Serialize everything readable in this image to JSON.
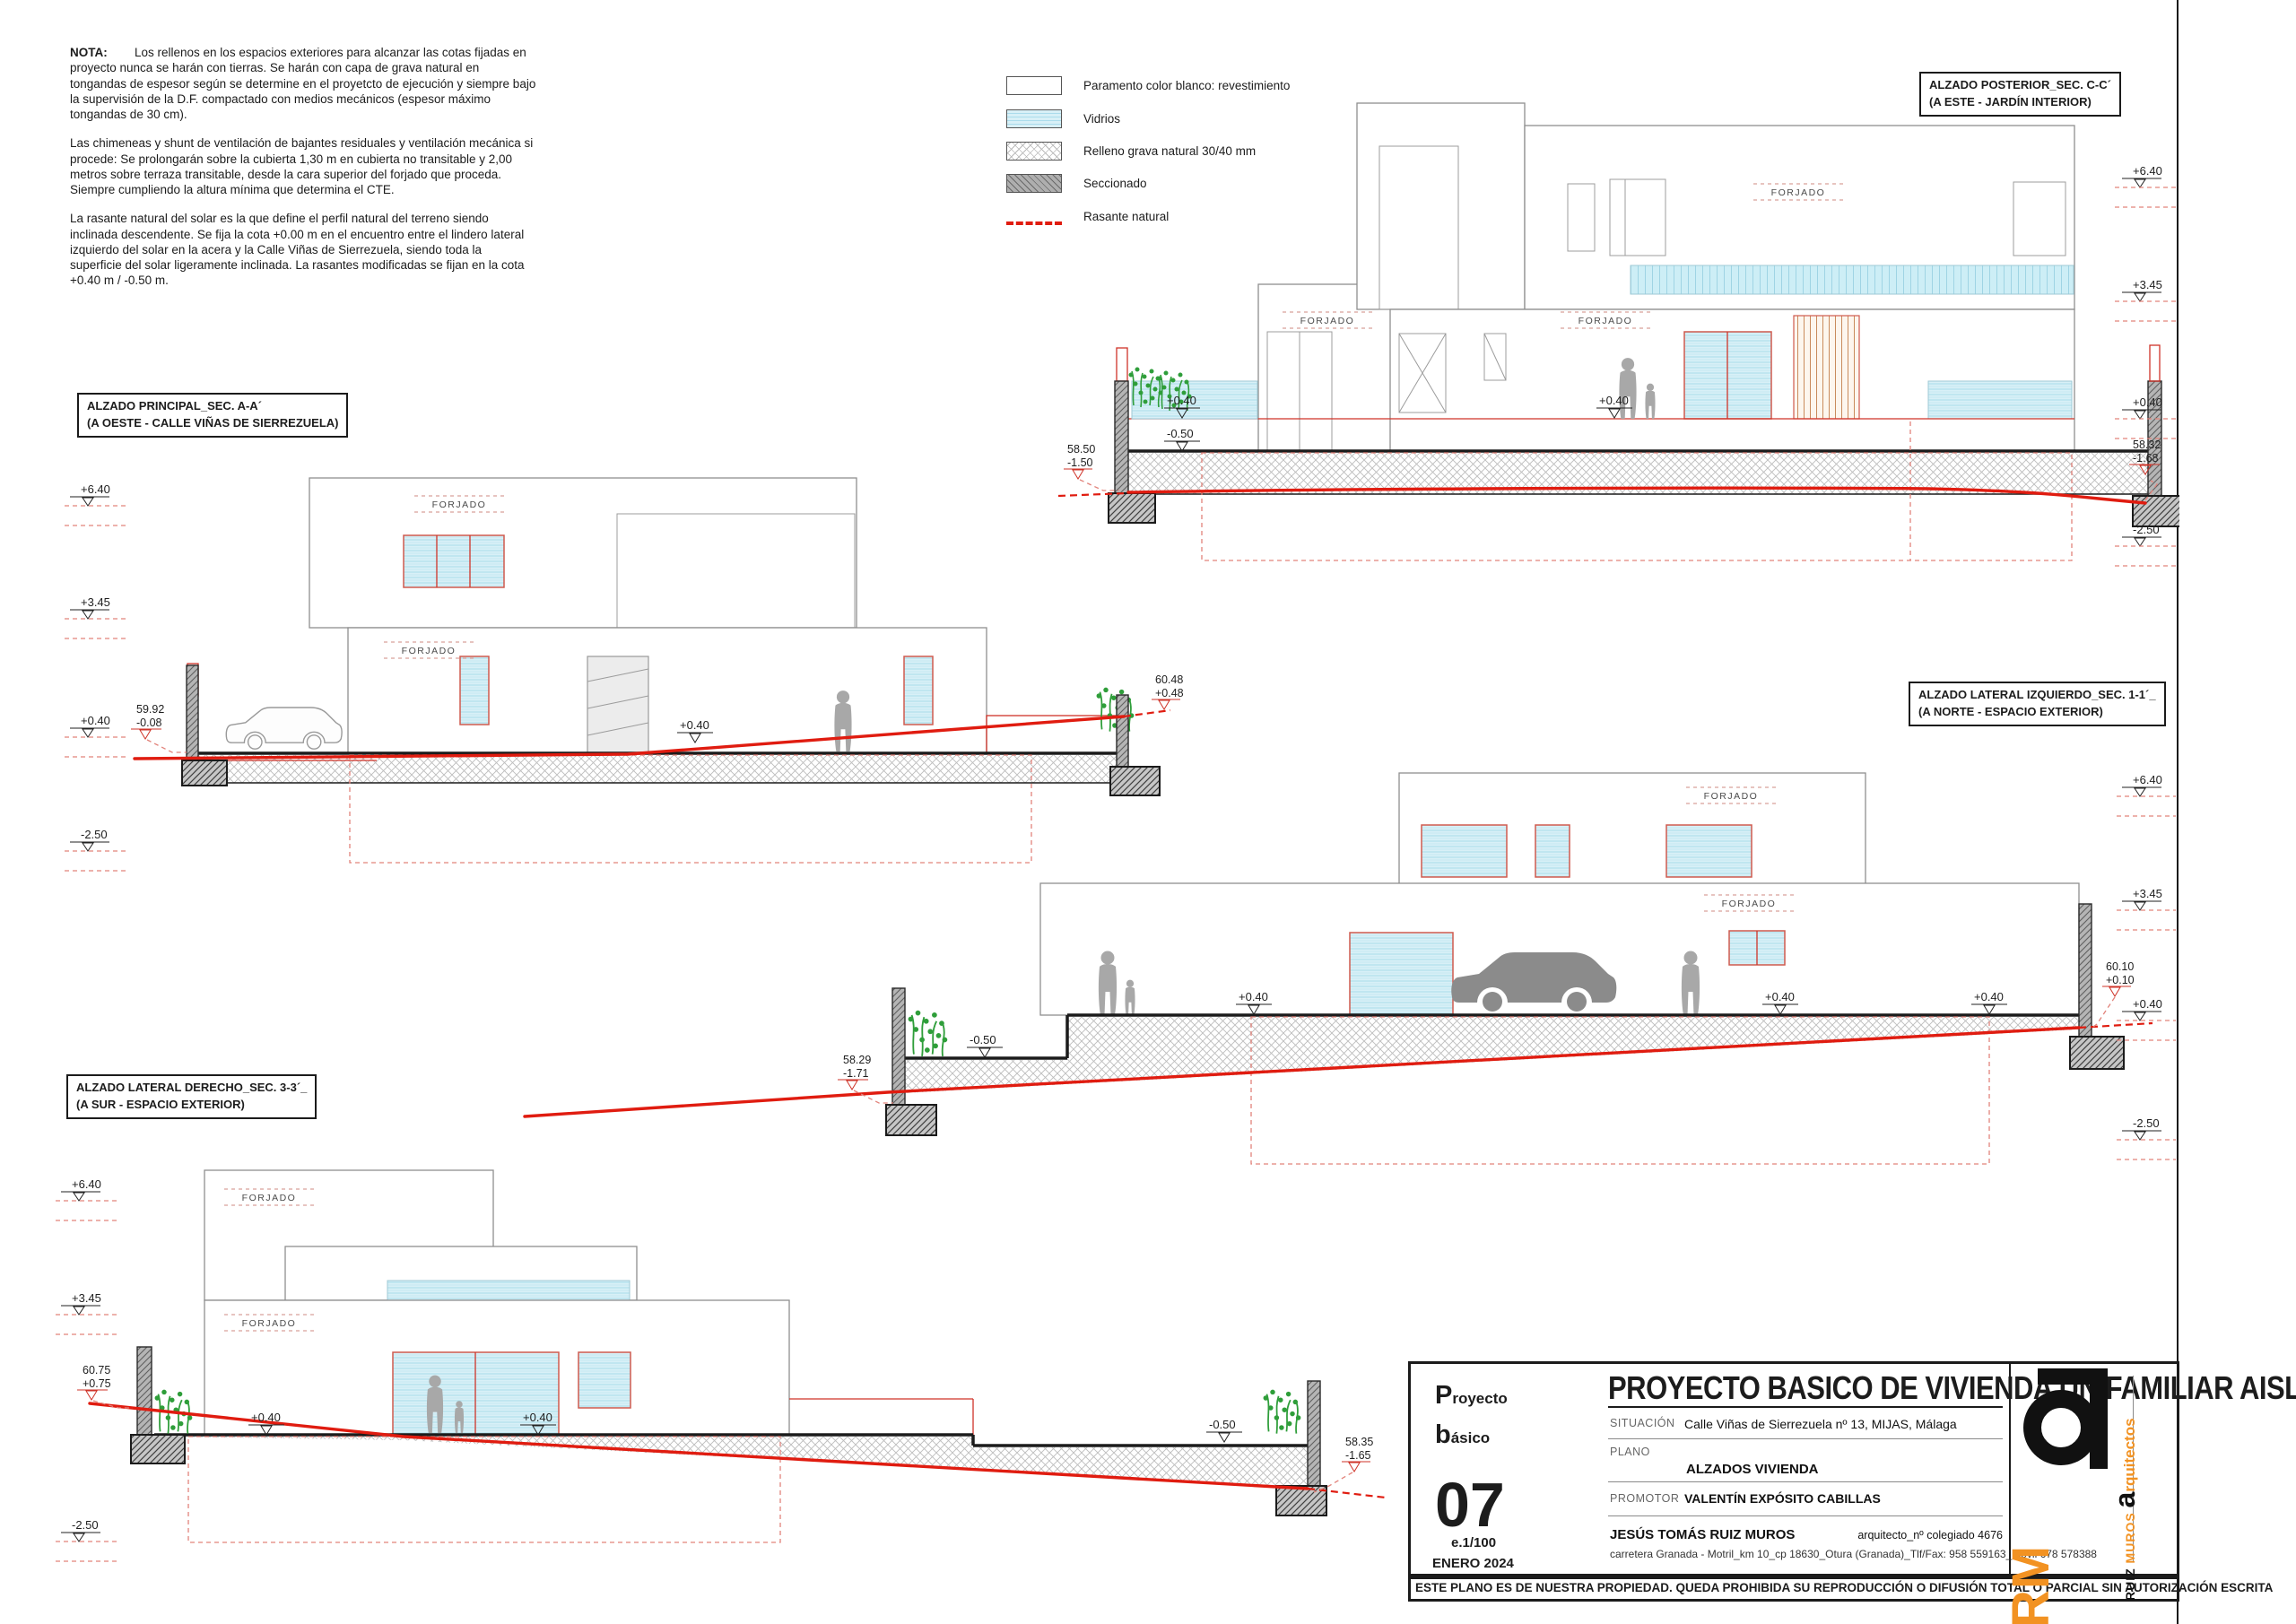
{
  "nota": {
    "label": "NOTA:",
    "p1": "Los rellenos en los espacios exteriores para alcanzar las cotas fijadas en proyecto nunca se harán con tierras. Se harán con capa de grava natural en tongandas de espesor según se determine en el proyetcto de ejecución y siempre bajo la supervisión de la D.F. compactado con medios mecánicos (espesor máximo tongandas de 30 cm).",
    "p2": "Las chimeneas y shunt de ventilación de bajantes residuales y ventilación mecánica si procede: Se prolongarán sobre la cubierta 1,30 m en cubierta no transitable y 2,00 metros sobre terraza transitable, desde la cara superior del forjado que proceda. Siempre cumpliendo la altura mínima que determina el CTE.",
    "p3": "La rasante natural del solar es la que define el perfil natural del terreno siendo inclinada descendente. Se fija la cota +0.00 m en el encuentro entre el lindero lateral izquierdo del solar en la acera y la Calle Viñas de Sierrezuela, siendo toda la superficie del solar ligeramente inclinada. La rasantes modificadas se fijan en la cota +0.40 m / -0.50 m."
  },
  "legend": {
    "paramento": "Paramento color blanco: revestimiento",
    "vidrios": "Vidrios",
    "grava": "Relleno grava natural 30/40 mm",
    "seccionado": "Seccionado",
    "rasante": "Rasante natural"
  },
  "sections": {
    "posterior": {
      "title": "ALZADO POSTERIOR_SEC. C-C´",
      "subtitle": "(A ESTE - JARDÍN INTERIOR)"
    },
    "principal": {
      "title": "ALZADO PRINCIPAL_SEC. A-A´",
      "subtitle": "(A OESTE - CALLE VIÑAS DE SIERREZUELA)"
    },
    "izquierdo": {
      "title": "ALZADO LATERAL IZQUIERDO_SEC. 1-1´_",
      "subtitle": "(A NORTE - ESPACIO EXTERIOR)"
    },
    "derecho": {
      "title": "ALZADO LATERAL DERECHO_SEC. 3-3´_",
      "subtitle": "(A SUR - ESPACIO EXTERIOR)"
    }
  },
  "drawings": {
    "forjado": "FORJADO",
    "posterior": {
      "marks": [
        "+6.40",
        "+3.45",
        "+0.40",
        "-2.50"
      ],
      "left_abs": "58.50",
      "left_rel": "-1.50",
      "right_abs": "58.32",
      "right_rel": "-1.68",
      "c1": "+0.40",
      "c2": "-0.50",
      "c3": "+0.40"
    },
    "principal": {
      "marks": [
        "+6.40",
        "+3.45",
        "+0.40",
        "-2.50"
      ],
      "left_abs": "59.92",
      "left_rel": "-0.08",
      "right_abs": "60.48",
      "right_rel": "+0.48",
      "c1": "+0.40"
    },
    "izquierdo": {
      "marks": [
        "+6.40",
        "+3.45",
        "+0.40",
        "-2.50"
      ],
      "left_abs": "58.29",
      "left_rel": "-1.71",
      "right_abs": "60.10",
      "right_rel": "+0.10",
      "c1": "+0.40",
      "c2": "+0.40",
      "c3": "+0.40",
      "c4": "-0.50"
    },
    "derecho": {
      "marks": [
        "+6.40",
        "+3.45",
        "-2.50"
      ],
      "left_abs": "60.75",
      "left_rel": "+0.75",
      "right_abs": "58.35",
      "right_rel": "-1.65",
      "c1": "+0.40",
      "c2": "+0.40",
      "c3": "-0.50"
    }
  },
  "titleblock": {
    "kicker_big1": "P",
    "kicker_rest1": "royecto",
    "kicker_big2": "b",
    "kicker_rest2": "ásico",
    "title": "PROYECTO BASICO DE VIVIENDA UNIFAMILIAR AISLADA",
    "situacion_label": "SITUACIÓN",
    "situacion": "Calle Viñas de Sierrezuela nº 13, MIJAS, Málaga",
    "plano_label": "PLANO",
    "plano": "ALZADOS VIVIENDA",
    "promotor_label": "PROMOTOR",
    "promotor": "VALENTÍN EXPÓSITO CABILLAS",
    "sheet_number": "07",
    "scale": "e.1/100",
    "date": "ENERO 2024",
    "architect": "JESÚS TOMÁS RUIZ MUROS",
    "architect_info": "arquitecto_nº colegiado 4676",
    "architect_address": "carretera Granada - Motril_km 10_cp 18630_Otura (Granada)_Tlf/Fax: 958 559163_móvil 678 578388",
    "copyright": "ESTE PLANO ES DE NUESTRA PROPIEDAD. QUEDA PROHIBIDA SU REPRODUCCIÓN O DIFUSIÓN TOTAL O PARCIAL  SIN AUTORIZACIÓN ESCRITA",
    "logo_rm": "RM",
    "logo_a": "a",
    "firm_ruiz": "RUIZ ",
    "firm_muros": "MUROS ",
    "firm_a": "a",
    "firm_rest": "rquitectos"
  }
}
